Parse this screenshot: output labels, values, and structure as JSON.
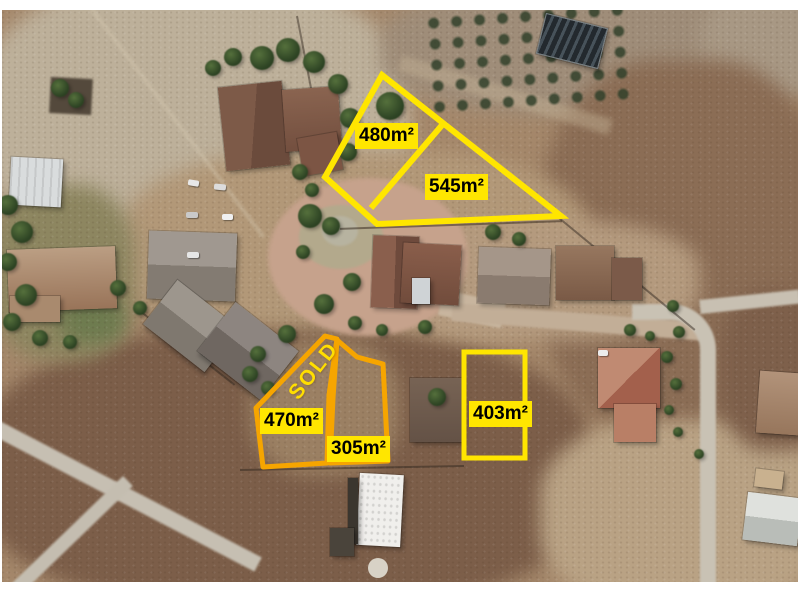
{
  "scene": {
    "kind": "aerial satellite photo",
    "subject": "Residential cul-de-sac with vacant land plots outlined for sale"
  },
  "colors": {
    "available_outline": "#FFE600",
    "orange_outline": "#F6A500",
    "label_background": "#FFE600",
    "label_text": "#000000",
    "sold_text": "#FFDE00"
  },
  "plots": {
    "p480": {
      "label": "480m²",
      "area_m2": 480,
      "outline": "yellow"
    },
    "p545": {
      "label": "545m²",
      "area_m2": 545,
      "outline": "yellow"
    },
    "p470": {
      "label": "470m²",
      "area_m2": 470,
      "outline": "orange"
    },
    "p305": {
      "label": "305m²",
      "area_m2": 305,
      "outline": "orange"
    },
    "p403": {
      "label": "403m²",
      "area_m2": 403,
      "outline": "yellow"
    },
    "sold": {
      "label": "SOLD"
    }
  }
}
